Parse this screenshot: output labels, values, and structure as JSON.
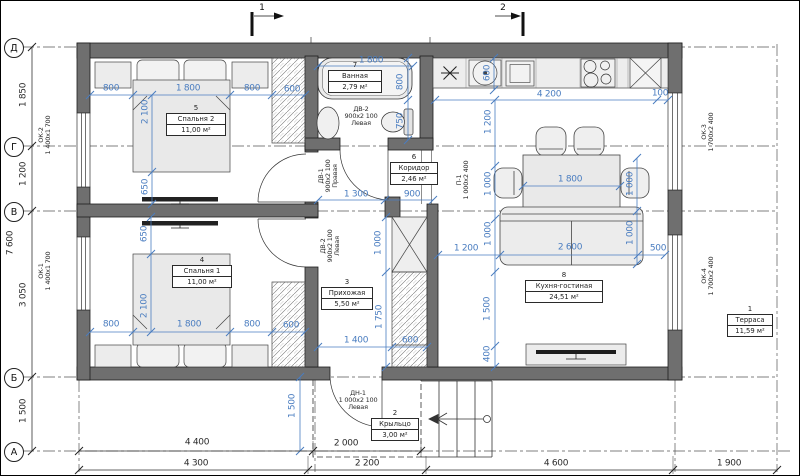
{
  "drawing": {
    "colors": {
      "dim_blue": "#4a7dc0",
      "wall_gray": "#6f6f6f",
      "line_black": "#333333"
    },
    "axes": [
      {
        "label": "Д",
        "y": 47
      },
      {
        "label": "Г",
        "y": 146
      },
      {
        "label": "В",
        "y": 211
      },
      {
        "label": "Б",
        "y": 377
      },
      {
        "label": "А",
        "y": 451
      }
    ],
    "sections": [
      {
        "label": "1",
        "x": 252,
        "lx": 262,
        "ly": 6
      },
      {
        "label": "2",
        "x": 523,
        "lx": 503,
        "ly": 6
      }
    ],
    "rooms": [
      {
        "num": "5",
        "name": "Спальня 2",
        "area": "11,00 м²",
        "cx": 196,
        "top": 114,
        "w": 58
      },
      {
        "num": "4",
        "name": "Спальня 1",
        "area": "11,00 м²",
        "cx": 202,
        "top": 266,
        "w": 58
      },
      {
        "num": "7",
        "name": "Ванная",
        "area": "2,79 м²",
        "cx": 355,
        "top": 71,
        "w": 52
      },
      {
        "num": "6",
        "name": "Коридор",
        "area": "2,46 м²",
        "cx": 414,
        "top": 163,
        "w": 46
      },
      {
        "num": "3",
        "name": "Прихожая",
        "area": "5,50 м²",
        "cx": 347,
        "top": 288,
        "w": 50
      },
      {
        "num": "8",
        "name": "Кухня-гостиная",
        "area": "24,51 м²",
        "cx": 564,
        "top": 281,
        "w": 76
      },
      {
        "num": "2",
        "name": "Крыльцо",
        "area": "3,00 м²",
        "cx": 395,
        "top": 419,
        "w": 46
      },
      {
        "num": "1",
        "name": "Терраса",
        "area": "11,59 м²",
        "cx": 750,
        "top": 315,
        "w": 44
      }
    ],
    "labels": {
      "dims_blue": [
        {
          "t": "800",
          "x": 111,
          "y": 89
        },
        {
          "t": "1 800",
          "x": 188,
          "y": 89
        },
        {
          "t": "800",
          "x": 252,
          "y": 89
        },
        {
          "t": "600",
          "x": 292,
          "y": 90
        },
        {
          "t": "2 100",
          "x": 146,
          "y": 112,
          "r": 1
        },
        {
          "t": "650",
          "x": 146,
          "y": 187,
          "r": 1
        },
        {
          "t": "650",
          "x": 145,
          "y": 234,
          "r": 1
        },
        {
          "t": "2 100",
          "x": 145,
          "y": 306,
          "r": 1
        },
        {
          "t": "800",
          "x": 111,
          "y": 325
        },
        {
          "t": "1 800",
          "x": 189,
          "y": 325
        },
        {
          "t": "800",
          "x": 252,
          "y": 325
        },
        {
          "t": "600",
          "x": 291,
          "y": 326
        },
        {
          "t": "1 800",
          "x": 371,
          "y": 61
        },
        {
          "t": "800",
          "x": 401,
          "y": 82,
          "r": 1
        },
        {
          "t": "750",
          "x": 401,
          "y": 121,
          "r": 1
        },
        {
          "t": "1 300",
          "x": 356,
          "y": 195
        },
        {
          "t": "900",
          "x": 412,
          "y": 195
        },
        {
          "t": "1 000",
          "x": 379,
          "y": 243,
          "r": 1
        },
        {
          "t": "1 750",
          "x": 380,
          "y": 317,
          "r": 1
        },
        {
          "t": "1 400",
          "x": 356,
          "y": 341
        },
        {
          "t": "600",
          "x": 410,
          "y": 341
        },
        {
          "t": "600",
          "x": 488,
          "y": 73,
          "r": 1
        },
        {
          "t": "4 200",
          "x": 549,
          "y": 95
        },
        {
          "t": "100",
          "x": 660,
          "y": 94
        },
        {
          "t": "1 200",
          "x": 489,
          "y": 122,
          "r": 1
        },
        {
          "t": "1 000",
          "x": 489,
          "y": 184,
          "r": 1
        },
        {
          "t": "1 000",
          "x": 489,
          "y": 234,
          "r": 1
        },
        {
          "t": "1 500",
          "x": 488,
          "y": 309,
          "r": 1
        },
        {
          "t": "400",
          "x": 488,
          "y": 354,
          "r": 1
        },
        {
          "t": "1 800",
          "x": 570,
          "y": 180
        },
        {
          "t": "1 000",
          "x": 631,
          "y": 184,
          "r": 1
        },
        {
          "t": "1 000",
          "x": 631,
          "y": 233,
          "r": 1
        },
        {
          "t": "1 200",
          "x": 466,
          "y": 249
        },
        {
          "t": "2 600",
          "x": 570,
          "y": 248
        },
        {
          "t": "500",
          "x": 658,
          "y": 249
        },
        {
          "t": "1 500",
          "x": 293,
          "y": 406,
          "r": 1
        }
      ],
      "dims_black": [
        {
          "t": "1 850",
          "x": 24,
          "y": 95,
          "r": 1
        },
        {
          "t": "1 200",
          "x": 24,
          "y": 174,
          "r": 1
        },
        {
          "t": "3 050",
          "x": 24,
          "y": 295,
          "r": 1
        },
        {
          "t": "1 500",
          "x": 24,
          "y": 411,
          "r": 1
        },
        {
          "t": "7 600",
          "x": 11,
          "y": 243,
          "r": 1
        },
        {
          "t": "4 400",
          "x": 197,
          "y": 443
        },
        {
          "t": "2 000",
          "x": 346,
          "y": 444
        },
        {
          "t": "4 300",
          "x": 196,
          "y": 464
        },
        {
          "t": "2 200",
          "x": 367,
          "y": 464
        },
        {
          "t": "4 600",
          "x": 556,
          "y": 464
        },
        {
          "t": "1 900",
          "x": 729,
          "y": 464
        }
      ],
      "tags": [
        {
          "t": "ОК-2\n1 400х1 700",
          "x": 45,
          "y": 135,
          "r": 1
        },
        {
          "t": "ОК-1\n1 400х1 700",
          "x": 45,
          "y": 271,
          "r": 1
        },
        {
          "t": "ОК-3\n1 700х2 400",
          "x": 708,
          "y": 132,
          "r": 1
        },
        {
          "t": "ОК-4\n1 700х2 400",
          "x": 708,
          "y": 276,
          "r": 1
        },
        {
          "t": "ДВ-1\n900х2 100\nПравая",
          "x": 328,
          "y": 176,
          "r": 1
        },
        {
          "t": "ДВ-2\n900х2 100\nЛевая",
          "x": 330,
          "y": 246,
          "r": 1
        },
        {
          "t": "П-1\n1 000х2 400",
          "x": 463,
          "y": 180,
          "r": 1
        },
        {
          "t": "ДВ-2\n900х2 100\nЛевая",
          "x": 361,
          "y": 116
        },
        {
          "t": "ДН-1\n1 000х2 100\nЛевая",
          "x": 358,
          "y": 400
        }
      ]
    }
  }
}
